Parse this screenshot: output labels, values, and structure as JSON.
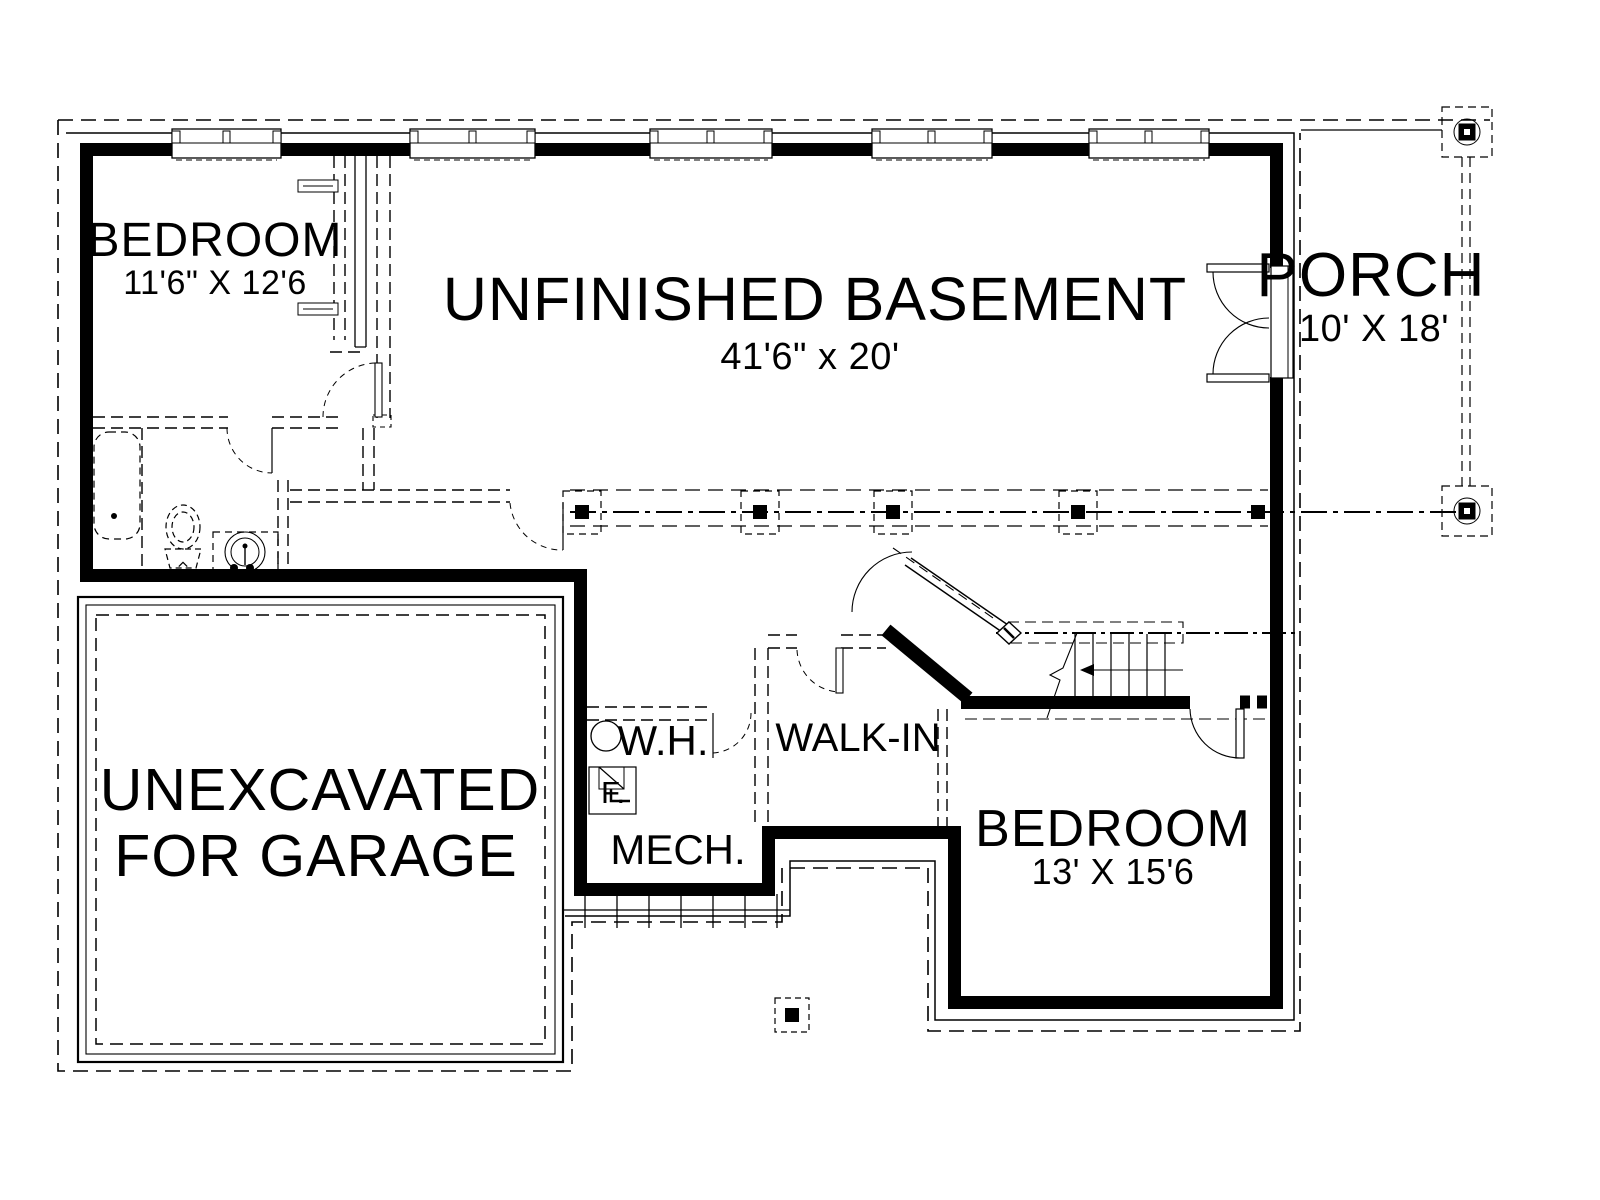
{
  "rooms": {
    "bedroom1": {
      "label": "BEDROOM",
      "dims": "11'6\" X 12'6"
    },
    "basement": {
      "label": "UNFINISHED BASEMENT",
      "dims": "41'6\" x 20'"
    },
    "porch": {
      "label": "PORCH",
      "dims": "10' X 18'"
    },
    "garage": {
      "line1": "UNEXCAVATED",
      "line2": "FOR GARAGE"
    },
    "water_heater": {
      "label": "W.H."
    },
    "furnace": {
      "label": "F."
    },
    "mech": {
      "label": "MECH."
    },
    "walkin": {
      "label": "WALK-IN"
    },
    "bedroom2": {
      "label": "BEDROOM",
      "dims": "13' X 15'6"
    }
  },
  "colors": {
    "ink": "#000000",
    "paper": "#ffffff"
  }
}
